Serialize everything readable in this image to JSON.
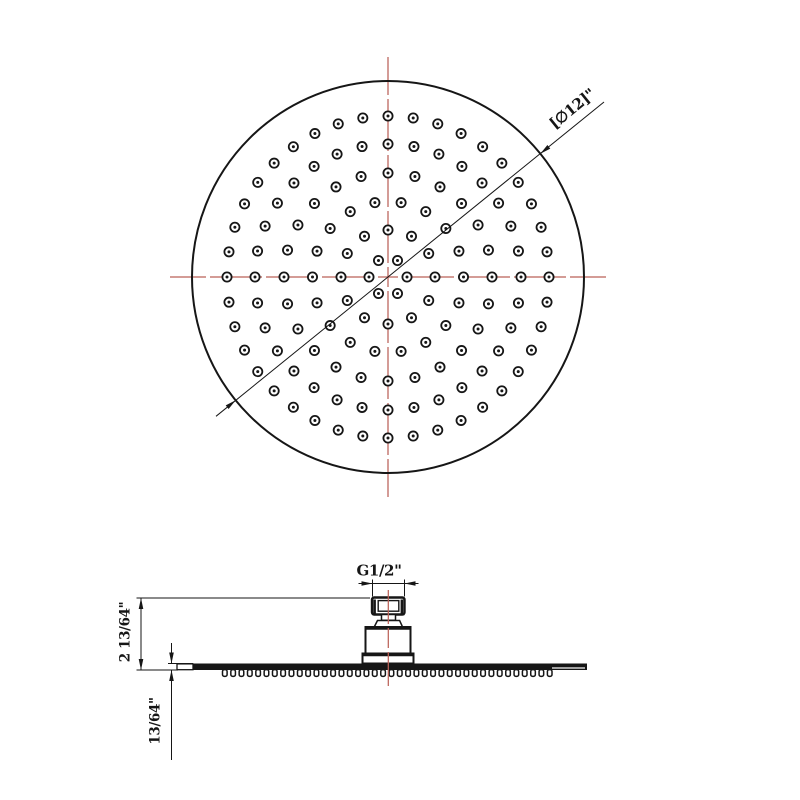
{
  "drawing": {
    "colors": {
      "line": "#161616",
      "centerline": "#bb6158",
      "background": "#ffffff"
    },
    "top_view": {
      "description": "shower head face, round",
      "center": {
        "x": 388,
        "y": 277
      },
      "radius": 196,
      "diameter_label": "[∅12]\"",
      "hole_rings": [
        {
          "radius": 19,
          "count": 6
        },
        {
          "radius": 47,
          "count": 12
        },
        {
          "radius": 75.5,
          "count": 18
        },
        {
          "radius": 104,
          "count": 24
        },
        {
          "radius": 133,
          "count": 32
        },
        {
          "radius": 161,
          "count": 40
        }
      ]
    },
    "side_view": {
      "description": "shower head profile with inlet connector",
      "thread_label": "G1/2\"",
      "height_label": "2 13/64\"",
      "thickness_label": "13/64\"",
      "teeth": {
        "count": 40,
        "x_start": 222.5,
        "x_end": 552
      }
    }
  }
}
